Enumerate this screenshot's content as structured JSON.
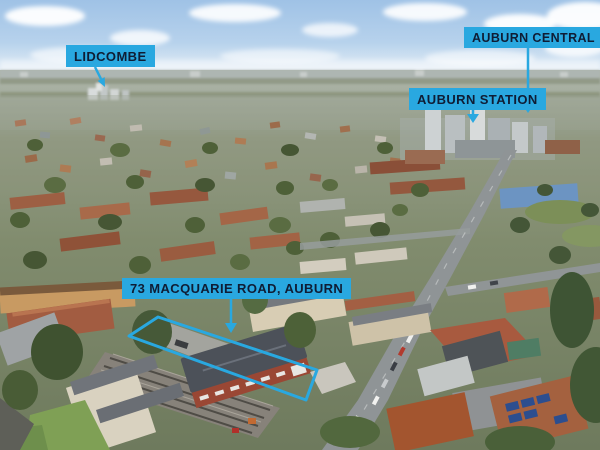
{
  "annotations": {
    "lidcombe": {
      "label": "LIDCOMBE"
    },
    "auburn_central": {
      "label": "AUBURN CENTRAL"
    },
    "auburn_station": {
      "label": "AUBURN STATION"
    },
    "property": {
      "label": "73 MACQUARIE ROAD, AUBURN"
    }
  },
  "colors": {
    "label_background": "#29A8E0",
    "label_text": "#0F1D35",
    "property_outline": "#29A8E0"
  }
}
